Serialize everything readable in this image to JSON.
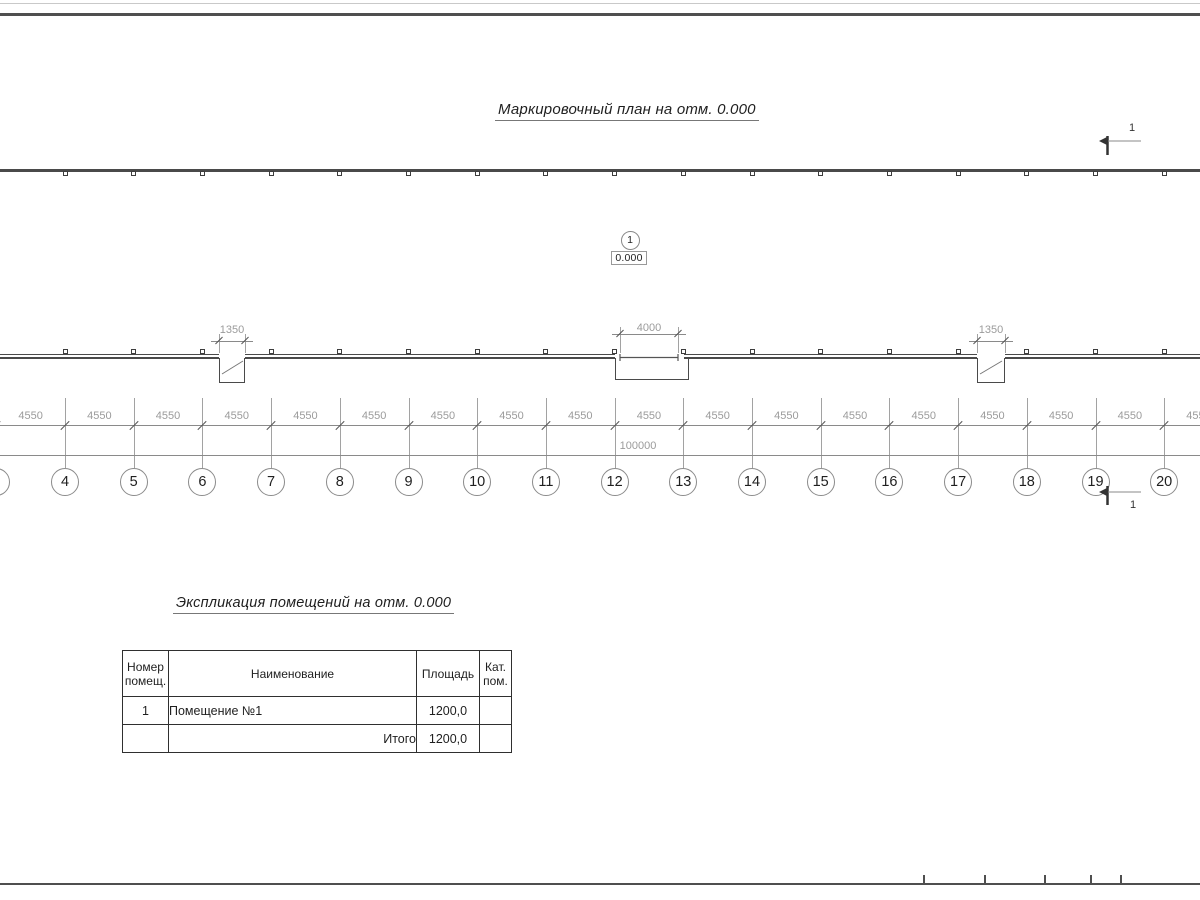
{
  "titles": {
    "plan": "Маркировочный план на отм. 0.000",
    "table_title": "Экспликация помещений на отм. 0.000"
  },
  "plan": {
    "axis_numbers": [
      "4",
      "5",
      "6",
      "7",
      "8",
      "9",
      "10",
      "11",
      "12",
      "13",
      "14",
      "15",
      "16",
      "17",
      "18",
      "19",
      "20"
    ],
    "bay_dimension": "4550",
    "total_dimension": "100000",
    "door_dimensions": [
      "1350",
      "4000",
      "1350"
    ],
    "room_marker": {
      "number": "1",
      "elevation": "0.000"
    },
    "section_mark_label": "1"
  },
  "table": {
    "headers": {
      "number": "Номер помещ.",
      "name": "Наименование",
      "area": "Площадь",
      "category": "Кат. пом."
    },
    "rows": [
      {
        "number": "1",
        "name": "Помещение №1",
        "area": "1200,0",
        "category": ""
      }
    ],
    "total_label": "Итого",
    "total_area": "1200,0",
    "total_category": ""
  },
  "colors": {
    "wall": "#4a4a4a",
    "thin_line": "#8a8a8a",
    "dim_text": "#9b9b9b",
    "ink": "#2b2b2b",
    "frame": "#4f4f4f"
  }
}
